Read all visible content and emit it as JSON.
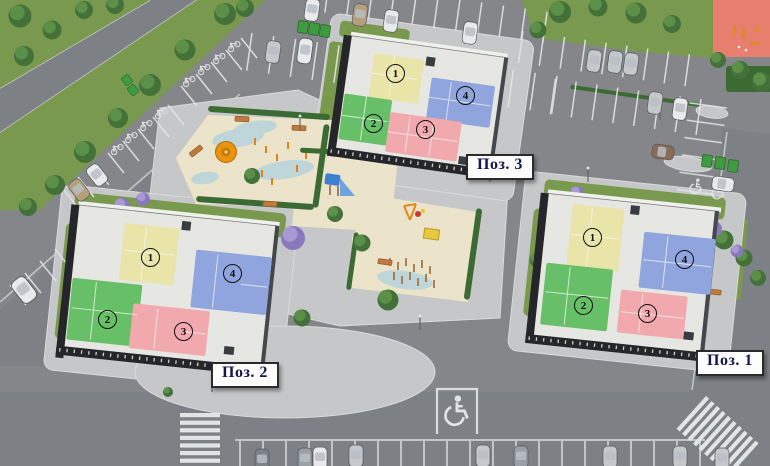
{
  "plan": {
    "buildings": [
      {
        "id": "pos-3",
        "label": "Поз. 3",
        "sections": [
          {
            "num": "1"
          },
          {
            "num": "2"
          },
          {
            "num": "3"
          },
          {
            "num": "4"
          }
        ]
      },
      {
        "id": "pos-2",
        "label": "Поз. 2",
        "sections": [
          {
            "num": "1"
          },
          {
            "num": "2"
          },
          {
            "num": "3"
          },
          {
            "num": "4"
          }
        ]
      },
      {
        "id": "pos-1",
        "label": "Поз. 1",
        "sections": [
          {
            "num": "1"
          },
          {
            "num": "2"
          },
          {
            "num": "3"
          },
          {
            "num": "4"
          }
        ]
      }
    ]
  },
  "colors": {
    "section1": "#e9e4a7",
    "section2": "#67c067",
    "section3": "#f1a9ad",
    "section4": "#90a5dd",
    "asphalt": "#84868a",
    "road": "#7d8084",
    "pavement": "#c6c7c9",
    "lawn": "#79994e",
    "sand": "#ebe3ca",
    "water": "#b7d4dd",
    "sports_court": "#e77e6e",
    "marking": "#e3e4e6"
  },
  "icons": {
    "wheelchair_marking": "wheelchair",
    "bicycle_marking": "bicycle"
  }
}
